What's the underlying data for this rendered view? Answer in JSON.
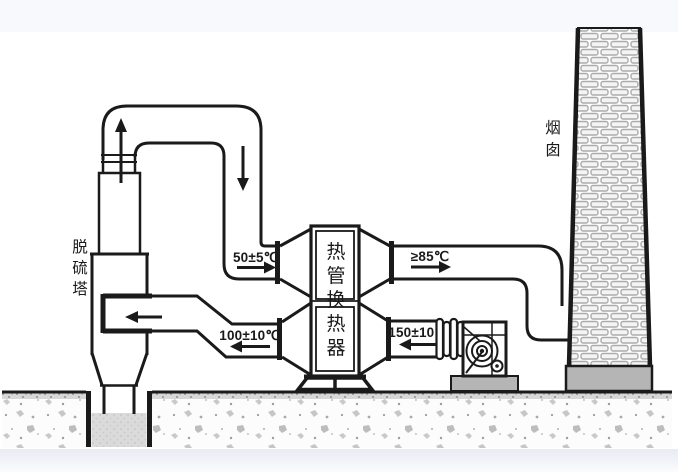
{
  "diagram": {
    "type": "process-schematic",
    "equipment": {
      "tower_label": "脱硫塔",
      "chimney_label": "烟囱",
      "heat_exchanger_label": "热管换热器"
    },
    "temperatures": {
      "clean_gas_to_exchanger": "50±5℃",
      "reheated_gas_to_chimney": "≥85℃",
      "cooled_gas_to_tower": "100±10℃",
      "hot_flue_gas_in": "150±10℃"
    },
    "colors": {
      "line": "#1a1a1a",
      "brick_mortar": "#ababab",
      "masonry_base": "#b5b5b5",
      "pit_liquid": "#dadada",
      "concrete_speckle": "#c6c6c6"
    }
  }
}
